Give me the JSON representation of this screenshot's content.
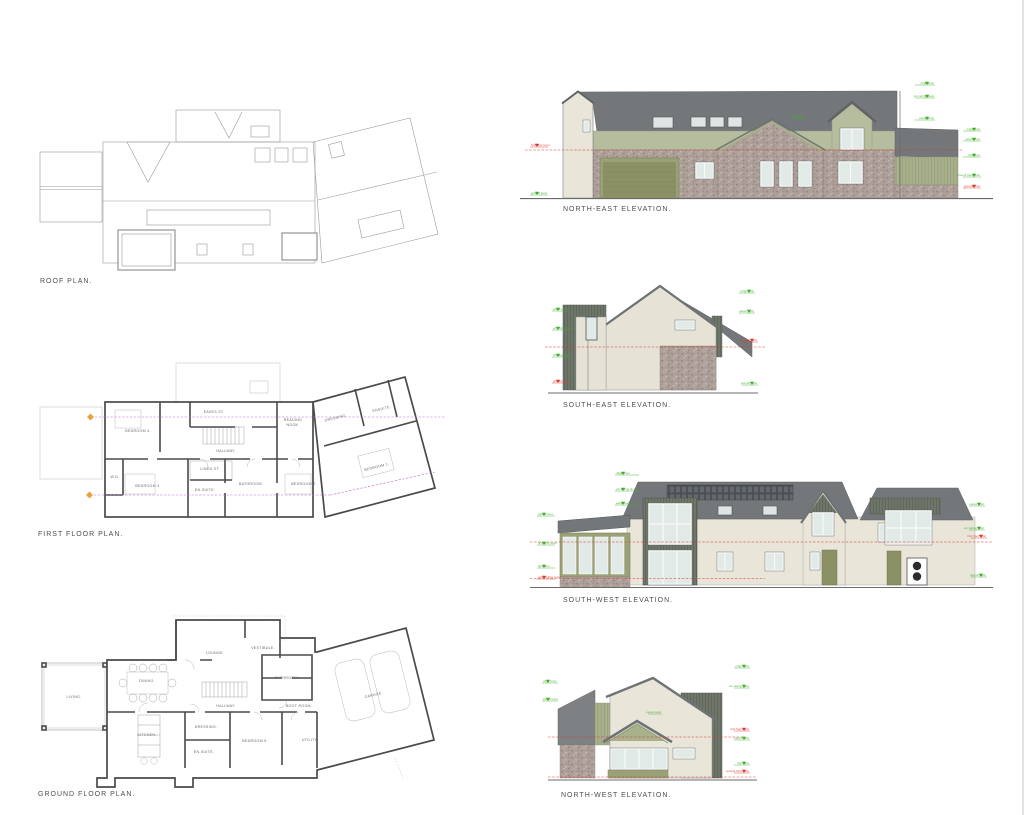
{
  "sheet": {
    "background": "#ffffff"
  },
  "colors": {
    "roof_gray": "#73777a",
    "roof_gray_light": "#7d8183",
    "render_sage": "#b6bc9e",
    "render_cream": "#e9e6d9",
    "stone": "#ad9f99",
    "cladding_dark": "#6e766a",
    "cladding_sage": "#a9b08c",
    "door_olive": "#8b9164",
    "glass": "#e2eae7",
    "marker_green": "#43ad2c",
    "marker_red": "#d9392f",
    "section_magenta": "#c468d8",
    "plan_line": "#9a9a9a",
    "wall_line": "#4a4a4a"
  },
  "plans": {
    "roof": {
      "title": "ROOF PLAN."
    },
    "first": {
      "title": "FIRST FLOOR PLAN.",
      "rooms": {
        "bedroom4": "BEDROOM 4.",
        "eaves_st": "EAVES ST.",
        "reading1": "READING",
        "reading2": "NOOK.",
        "dressing": "DRESSING.",
        "ensuite_m": "ENSUITE.",
        "hallway": "HALLWAY.",
        "linen": "LINEN ST.",
        "wd": "W.D.",
        "bedroom3": "BEDROOM 3.",
        "ensuite3": "EN-SUITE.",
        "bathroom": "BATHROOM.",
        "bedroom2": "BEDROOM 2.",
        "bedroom1": "BEDROOM 1."
      }
    },
    "ground": {
      "title": "GROUND FLOOR PLAN.",
      "rooms": {
        "living": "LIVING.",
        "dining": "DINING.",
        "kitchen": "KITCHEN.",
        "lounge": "LOUNGE.",
        "vestibule": "VESTIBULE.",
        "hallway": "HALLWAY.",
        "bathroom": "BATHROOM.",
        "bootroom": "BOOT ROOM.",
        "dressing": "DRESSING.",
        "ensuite": "EN-SUITE.",
        "bedroom5": "BEDROOM 5.",
        "utility": "UTILITY.",
        "garage": "GARAGE."
      }
    }
  },
  "elevations": {
    "ne": {
      "title": "NORTH-EAST ELEVATION."
    },
    "se": {
      "title": "SOUTH-EAST ELEVATION."
    },
    "sw": {
      "title": "SOUTH-WEST ELEVATION."
    },
    "nw": {
      "title": "NORTH-WEST ELEVATION."
    }
  },
  "annotations": {
    "ridge": "ridge level",
    "eaves": "eaves level",
    "ceiling": "u/s ceiling level",
    "ffl": "first floor level",
    "gfl": "ground floor level",
    "dpc": "dpc level",
    "gl": "ground level"
  }
}
